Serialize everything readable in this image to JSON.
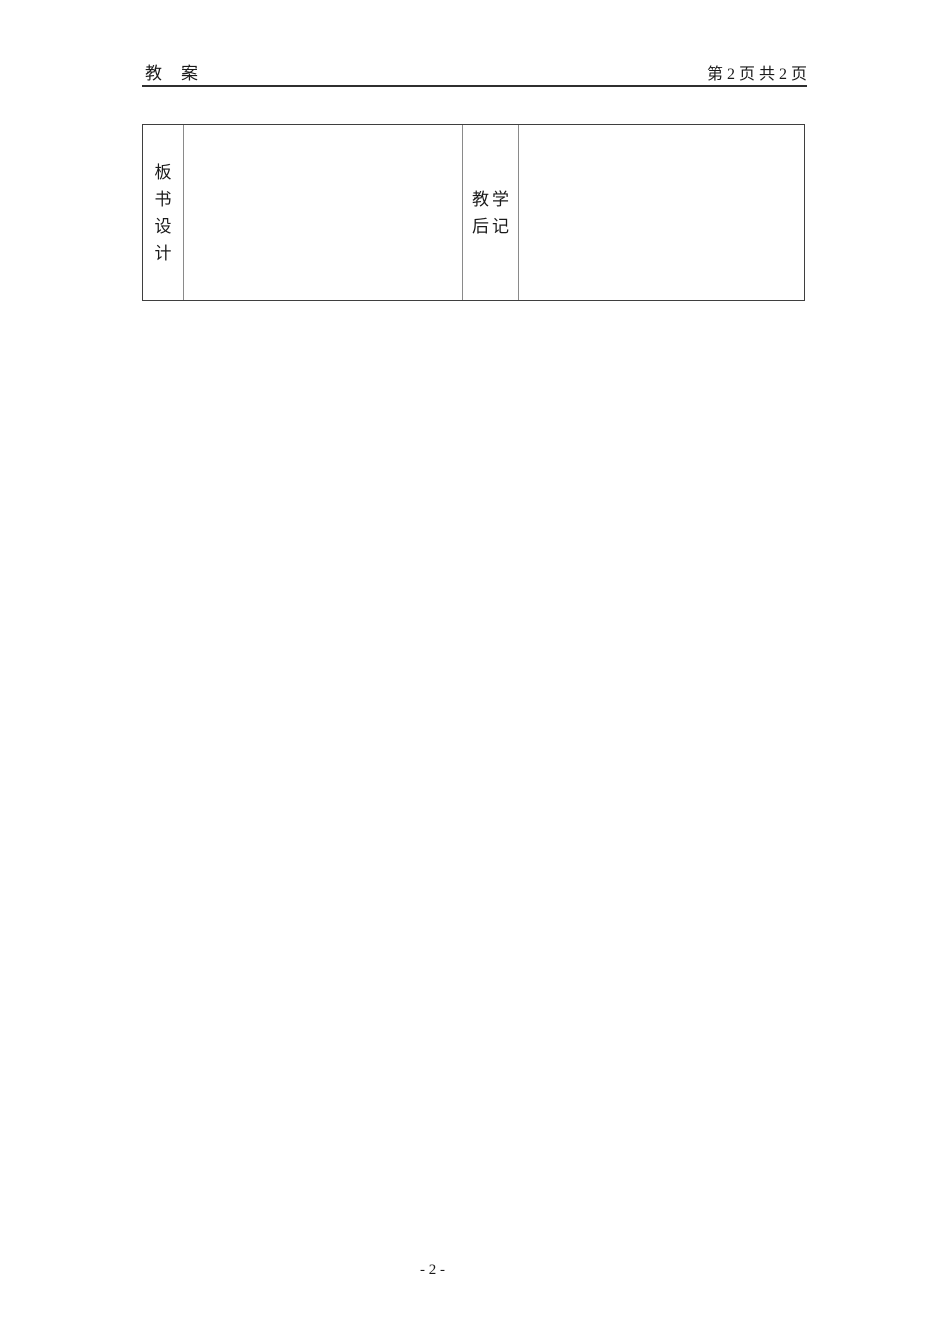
{
  "header": {
    "left_title": "教　案",
    "right_page_info": "第 2 页 共 2 页"
  },
  "table": {
    "board_design_label": "板书设计",
    "board_design_chars": [
      "板",
      "书",
      "设",
      "计"
    ],
    "board_design_content": "",
    "teaching_notes_label": "教学后记",
    "teaching_notes_lines": [
      "教学",
      "后记"
    ],
    "teaching_notes_content": ""
  },
  "footer": {
    "page_number": "- 2 -"
  },
  "colors": {
    "background": "#ffffff",
    "text": "#1a1a1a",
    "header_rule": "#2f2f2f",
    "table_border_outer": "#3f3f3f",
    "table_border_inner": "#8a8a8a"
  }
}
